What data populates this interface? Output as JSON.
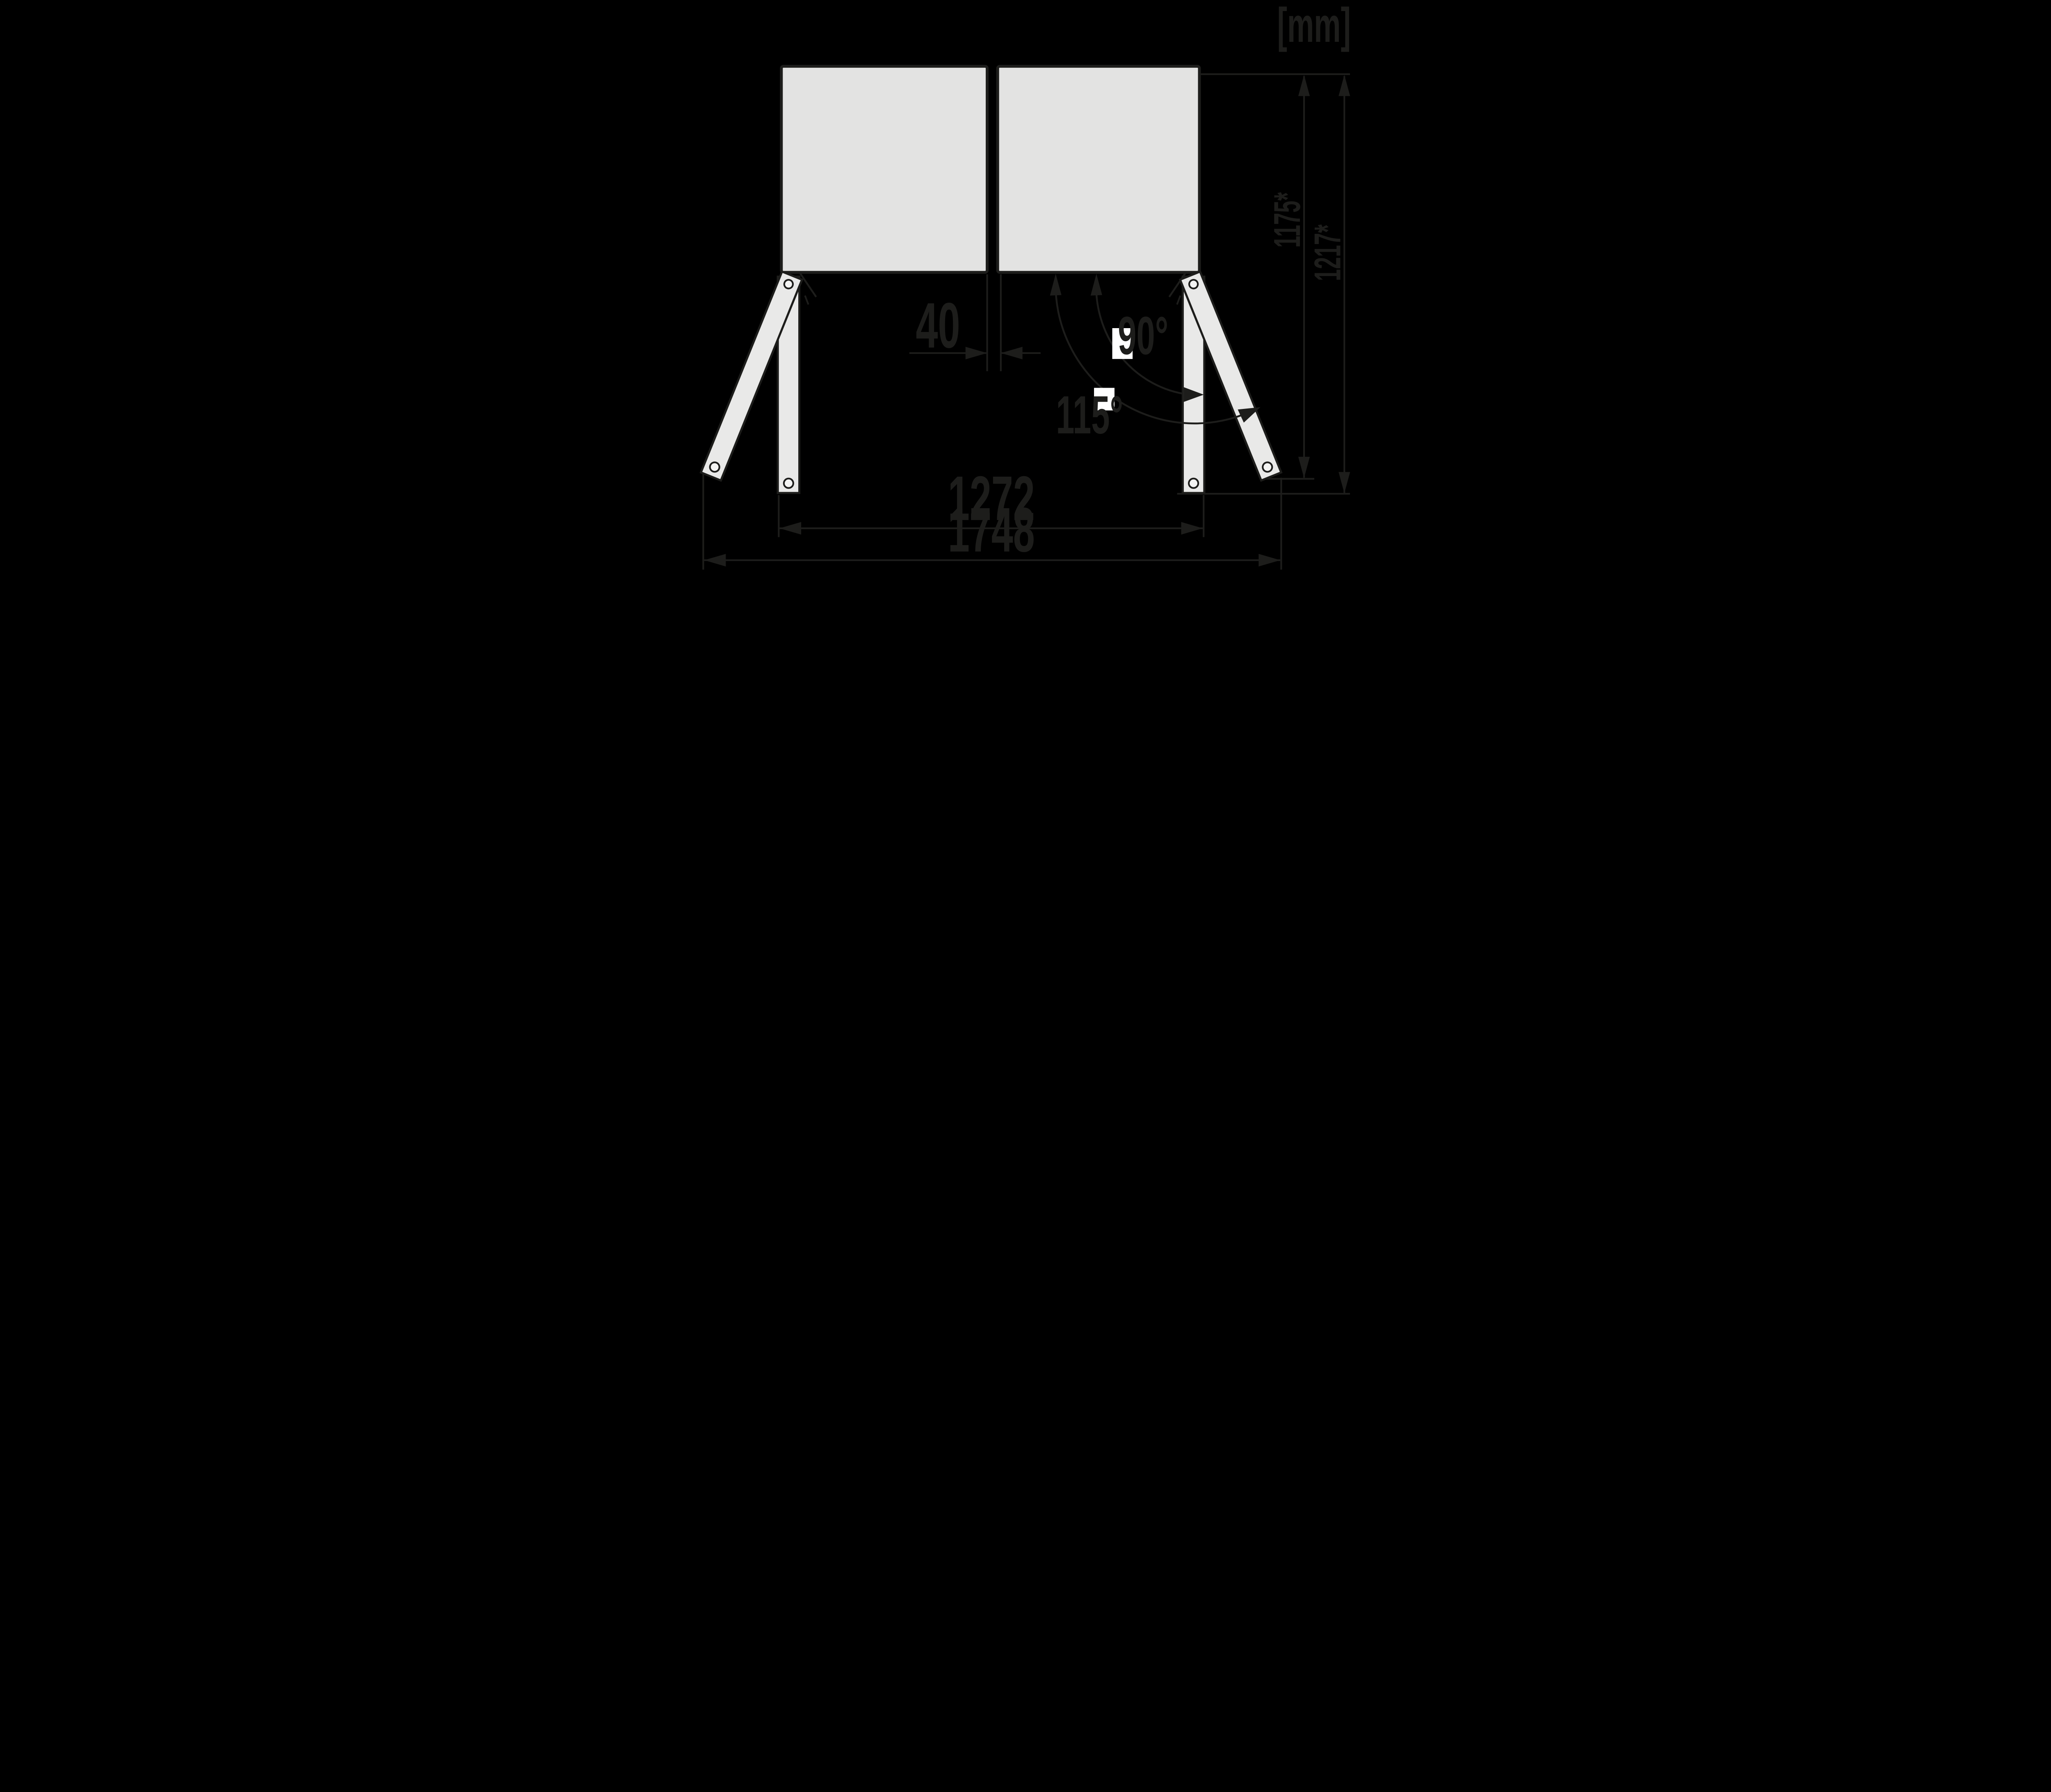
{
  "unit_label": "[mm]",
  "dimensions": {
    "door_gap_mm": "40",
    "width_between_open_doors_mm": "1272",
    "total_width_doors_open_mm": "1748",
    "depth_door_open_115_mm": "1175*",
    "depth_door_open_90_mm": "1217*"
  },
  "angles": {
    "opening_angle_standard": "90°",
    "opening_angle_max": "115°"
  },
  "colors": {
    "background": "#000000",
    "line": "#1d1d1b",
    "cabinet-fill": "#e3e3e2",
    "door-fill": "#e9e9e8",
    "pin-fill": "#f4f4f3",
    "mask-fill": "#ffffff"
  }
}
